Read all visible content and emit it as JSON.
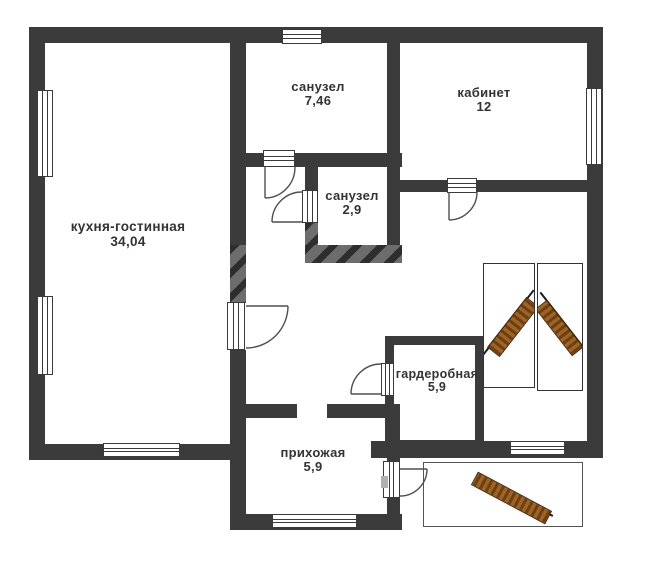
{
  "floorplan": {
    "rooms": [
      {
        "id": "kitchen-living",
        "name": "кухня-гостинная",
        "area": "34,04"
      },
      {
        "id": "bathroom-large",
        "name": "санузел",
        "area": "7,46"
      },
      {
        "id": "office",
        "name": "кабинет",
        "area": "12"
      },
      {
        "id": "bathroom-small",
        "name": "санузел",
        "area": "2,9"
      },
      {
        "id": "wardrobe",
        "name": "гардеробная",
        "area": "5,9"
      },
      {
        "id": "hallway",
        "name": "прихожая",
        "area": "5,9"
      }
    ],
    "colors": {
      "wall": "#3b3b3b",
      "wall_hatch": "#6d6d6d",
      "door_line": "#4f4f4f",
      "stair_wood_dark": "#6f3f12",
      "stair_wood_light": "#9c6526",
      "background": "#ffffff"
    }
  }
}
